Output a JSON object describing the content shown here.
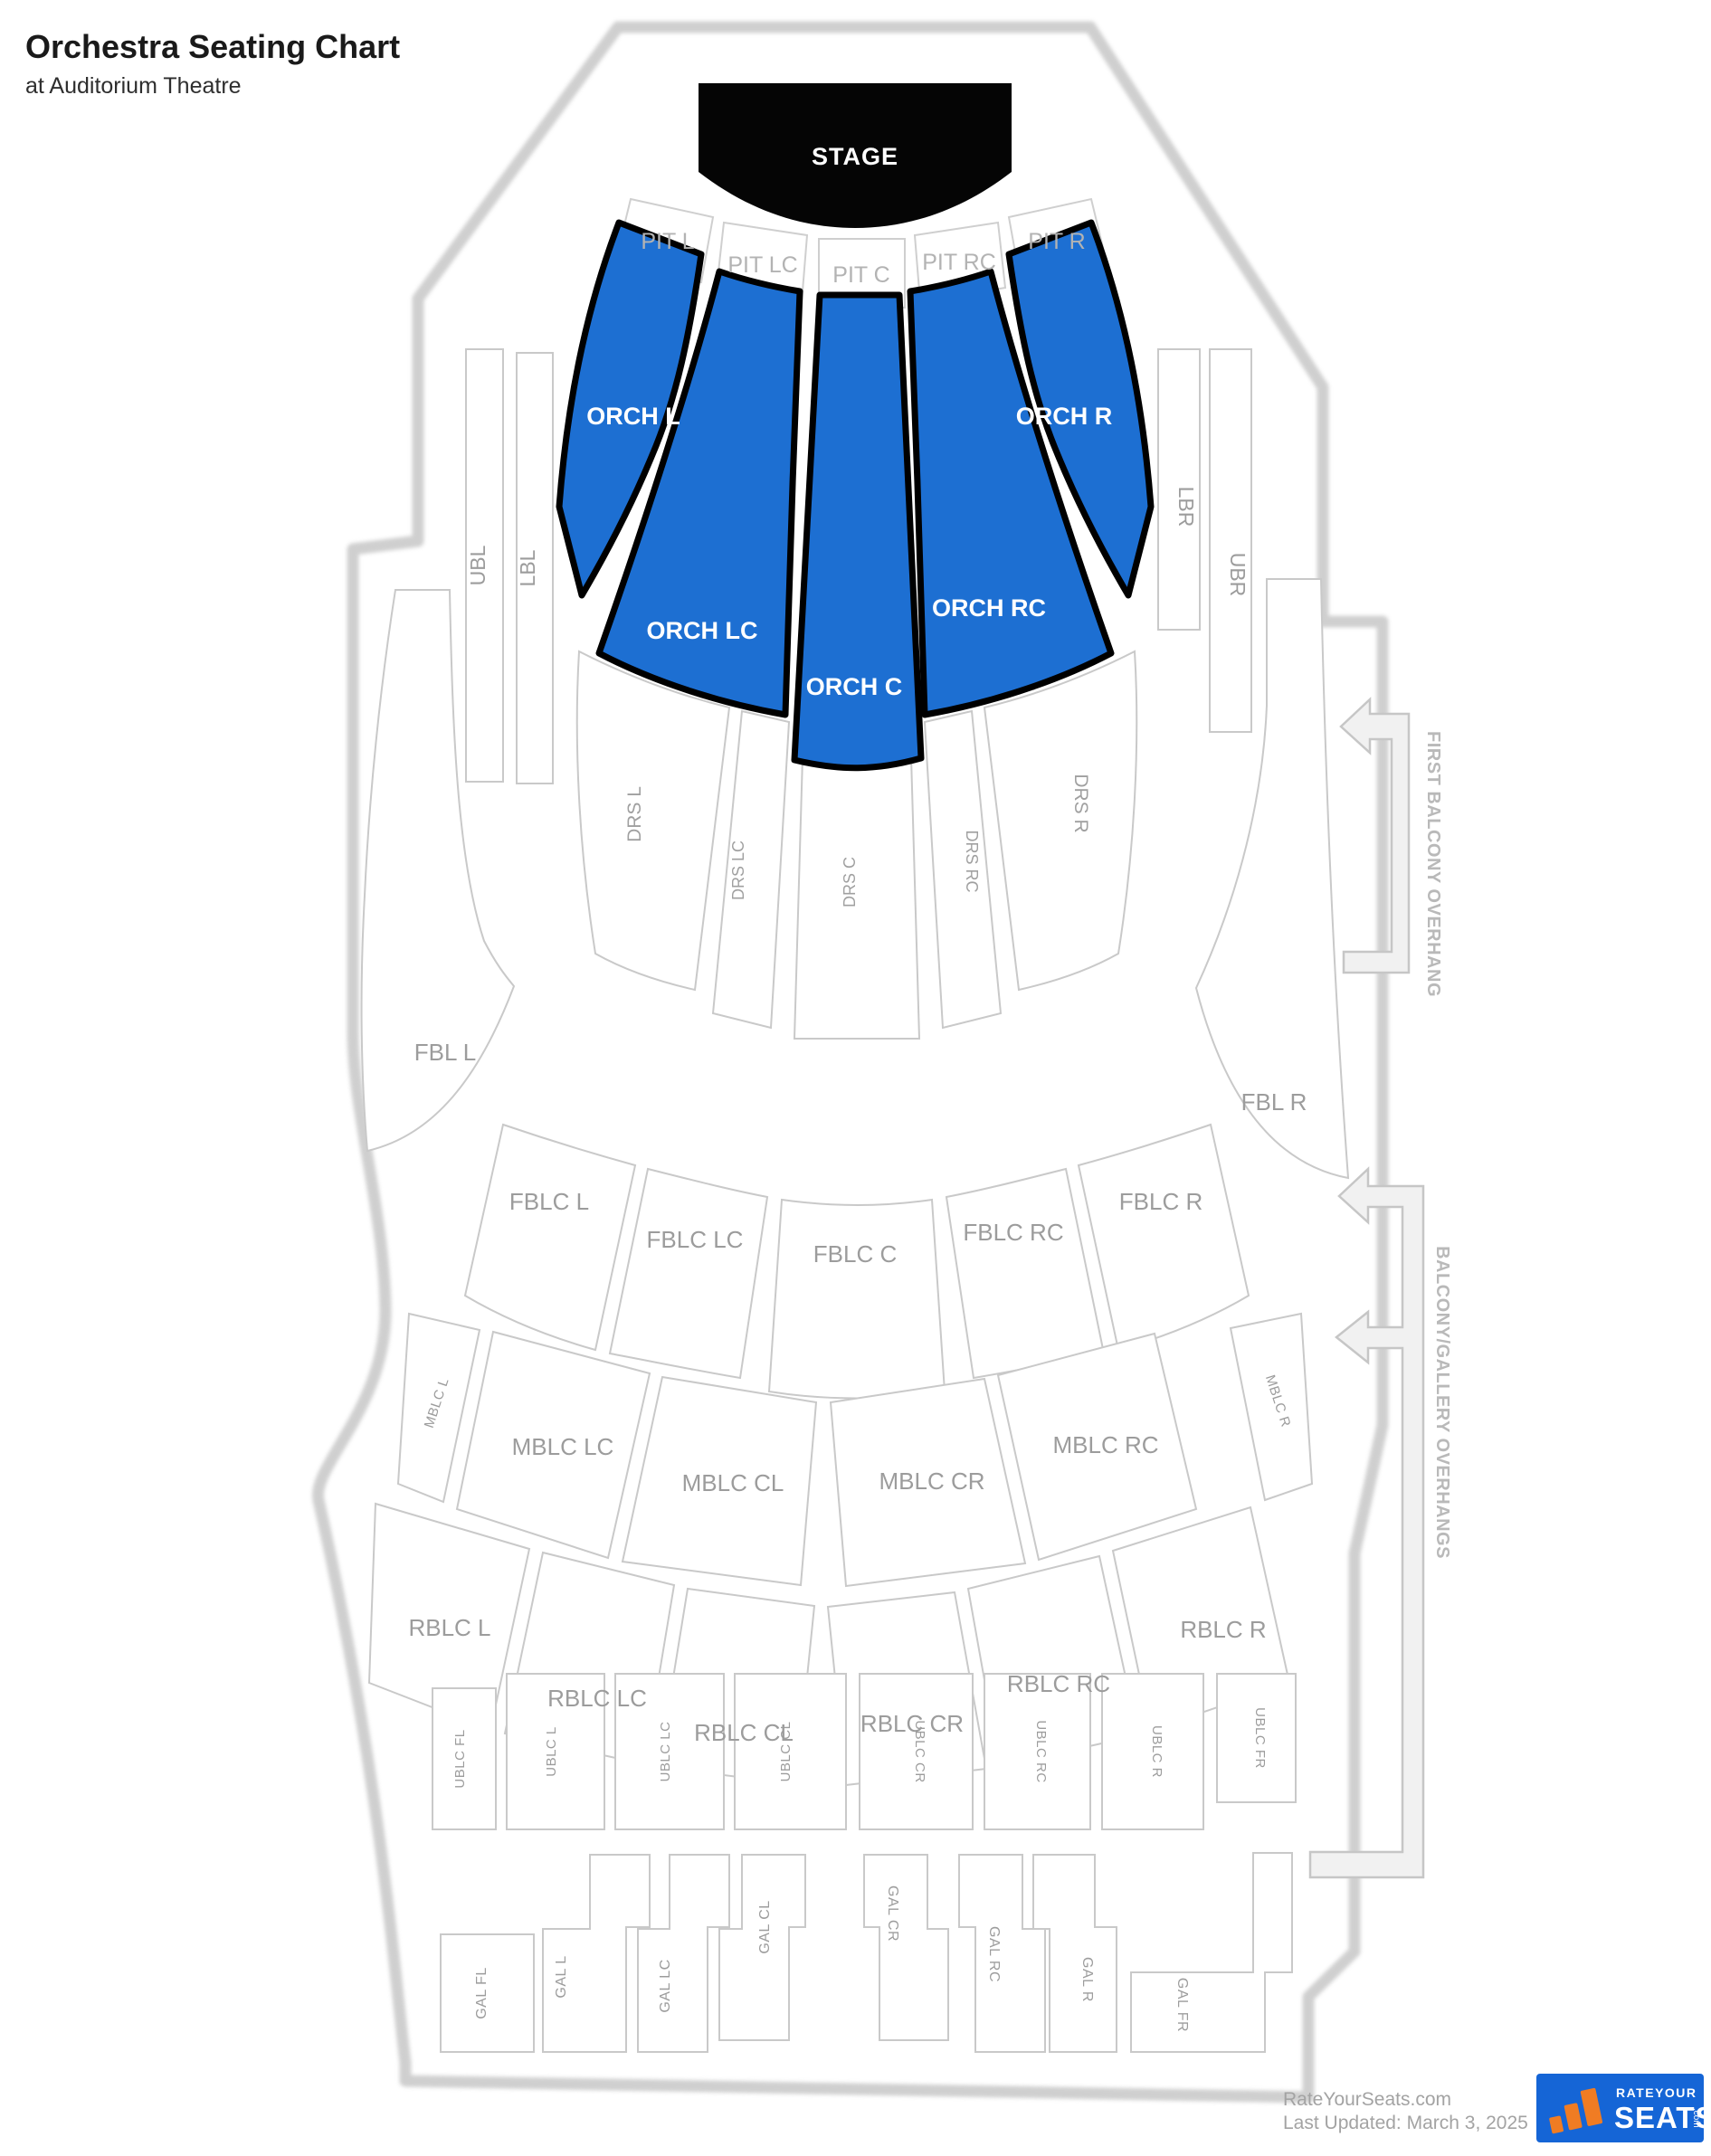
{
  "title": "Orchestra Seating Chart",
  "subtitle": "at Auditorium Theatre",
  "stage": {
    "label": "STAGE"
  },
  "pit": {
    "l": "PIT L",
    "lc": "PIT LC",
    "c": "PIT C",
    "rc": "PIT RC",
    "r": "PIT R"
  },
  "orch": {
    "l": "ORCH L",
    "lc": "ORCH LC",
    "c": "ORCH C",
    "rc": "ORCH RC",
    "r": "ORCH R"
  },
  "bars": {
    "ubl": "UBL",
    "lbl": "LBL",
    "lbr": "LBR",
    "ubr": "UBR"
  },
  "drs": {
    "l": "DRS L",
    "lc": "DRS LC",
    "c": "DRS C",
    "rc": "DRS RC",
    "r": "DRS R"
  },
  "fbl": {
    "l": "FBL L",
    "r": "FBL R"
  },
  "fblc": {
    "l": "FBLC L",
    "lc": "FBLC LC",
    "c": "FBLC C",
    "rc": "FBLC RC",
    "r": "FBLC R"
  },
  "mblc": {
    "l": "MBLC L",
    "lc": "MBLC LC",
    "cl": "MBLC CL",
    "cr": "MBLC CR",
    "rc": "MBLC RC",
    "r": "MBLC R"
  },
  "rblc": {
    "l": "RBLC L",
    "lc": "RBLC LC",
    "cl": "RBLC CL",
    "cr": "RBLC CR",
    "rc": "RBLC RC",
    "r": "RBLC R"
  },
  "ublc": {
    "fl": "UBLC FL",
    "l": "UBLC L",
    "lc": "UBLC LC",
    "cl": "UBLC CL",
    "cr": "UBLC CR",
    "rc": "UBLC RC",
    "r": "UBLC R",
    "fr": "UBLC FR"
  },
  "gal": {
    "fl": "GAL FL",
    "l": "GAL L",
    "lc": "GAL LC",
    "cl": "GAL CL",
    "cr": "GAL CR",
    "rc": "GAL RC",
    "r": "GAL R",
    "fr": "GAL FR"
  },
  "annotations": {
    "first_balcony": "FIRST BALCONY OVERHANG",
    "balcony_gallery": "BALCONY/GALLERY OVERHANGS"
  },
  "footer": {
    "site": "RateYourSeats.com",
    "last_updated": "Last Updated: March 3, 2025",
    "logo": {
      "rate_your": "RATEYOUR",
      "seats": "SEATS",
      "com": ".com"
    }
  },
  "colors": {
    "highlight_blue": "#1d6fd2",
    "stage_black": "#050505",
    "section_stroke": "#c9c9c9",
    "label_gray": "#9c9c9c",
    "logo_blue": "#1565d6",
    "logo_orange": "#f07c23"
  }
}
